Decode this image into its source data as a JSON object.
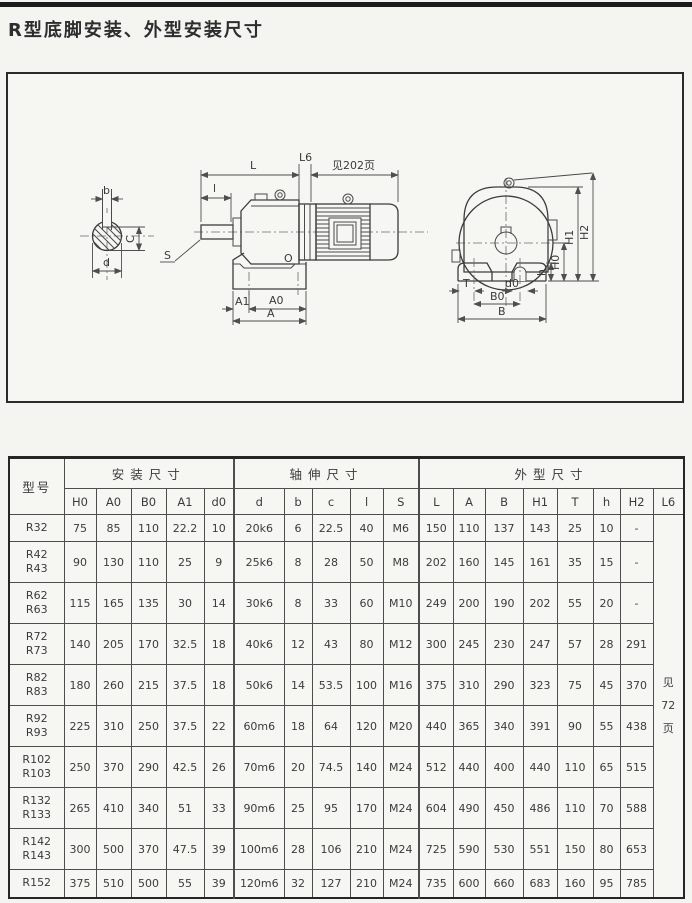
{
  "page": {
    "title": "R型底脚安装、外型安装尺寸"
  },
  "drawing": {
    "labels": {
      "key_b": "b",
      "dim_C": "C",
      "dia_d": "d",
      "thread_S": "S",
      "len_l": "l",
      "len_L": "L",
      "len_L6": "L6",
      "note_202": "见202页",
      "mark_O": "O",
      "dim_A1": "A1",
      "dim_A0": "A0",
      "dim_A": "A",
      "dim_T": "T",
      "dim_d0": "d0",
      "dim_B0": "B0",
      "dim_B": "B",
      "dim_h": "h",
      "dim_H0": "H0",
      "dim_H1": "H1",
      "dim_H2": "H2"
    }
  },
  "table": {
    "headers": {
      "model": "型号",
      "groups": [
        {
          "label": "安装尺寸",
          "span": 5
        },
        {
          "label": "轴伸尺寸",
          "span": 5
        },
        {
          "label": "外型尺寸",
          "span": 8
        }
      ],
      "cols": [
        "H0",
        "A0",
        "B0",
        "A1",
        "d0",
        "d",
        "b",
        "c",
        "l",
        "S",
        "L",
        "A",
        "B",
        "H1",
        "T",
        "h",
        "H2",
        "L6"
      ]
    },
    "l6_note": "见\n72\n页",
    "rows": [
      {
        "model": "R32",
        "values": [
          "75",
          "85",
          "110",
          "22.2",
          "10",
          "20k6",
          "6",
          "22.5",
          "40",
          "M6",
          "150",
          "110",
          "137",
          "143",
          "25",
          "10",
          "-"
        ]
      },
      {
        "model": "R42\nR43",
        "values": [
          "90",
          "130",
          "110",
          "25",
          "9",
          "25k6",
          "8",
          "28",
          "50",
          "M8",
          "202",
          "160",
          "145",
          "161",
          "35",
          "15",
          "-"
        ]
      },
      {
        "model": "R62\nR63",
        "values": [
          "115",
          "165",
          "135",
          "30",
          "14",
          "30k6",
          "8",
          "33",
          "60",
          "M10",
          "249",
          "200",
          "190",
          "202",
          "55",
          "20",
          "-"
        ]
      },
      {
        "model": "R72\nR73",
        "values": [
          "140",
          "205",
          "170",
          "32.5",
          "18",
          "40k6",
          "12",
          "43",
          "80",
          "M12",
          "300",
          "245",
          "230",
          "247",
          "57",
          "28",
          "291"
        ]
      },
      {
        "model": "R82\nR83",
        "values": [
          "180",
          "260",
          "215",
          "37.5",
          "18",
          "50k6",
          "14",
          "53.5",
          "100",
          "M16",
          "375",
          "310",
          "290",
          "323",
          "75",
          "45",
          "370"
        ]
      },
      {
        "model": "R92\nR93",
        "values": [
          "225",
          "310",
          "250",
          "37.5",
          "22",
          "60m6",
          "18",
          "64",
          "120",
          "M20",
          "440",
          "365",
          "340",
          "391",
          "90",
          "55",
          "438"
        ]
      },
      {
        "model": "R102\nR103",
        "values": [
          "250",
          "370",
          "290",
          "42.5",
          "26",
          "70m6",
          "20",
          "74.5",
          "140",
          "M24",
          "512",
          "440",
          "400",
          "440",
          "110",
          "65",
          "515"
        ]
      },
      {
        "model": "R132\nR133",
        "values": [
          "265",
          "410",
          "340",
          "51",
          "33",
          "90m6",
          "25",
          "95",
          "170",
          "M24",
          "604",
          "490",
          "450",
          "486",
          "110",
          "70",
          "588"
        ]
      },
      {
        "model": "R142\nR143",
        "values": [
          "300",
          "500",
          "370",
          "47.5",
          "39",
          "100m6",
          "28",
          "106",
          "210",
          "M24",
          "725",
          "590",
          "530",
          "551",
          "150",
          "80",
          "653"
        ]
      },
      {
        "model": "R152",
        "values": [
          "375",
          "510",
          "500",
          "55",
          "39",
          "120m6",
          "32",
          "127",
          "210",
          "M24",
          "735",
          "600",
          "660",
          "683",
          "160",
          "95",
          "785"
        ]
      }
    ]
  }
}
